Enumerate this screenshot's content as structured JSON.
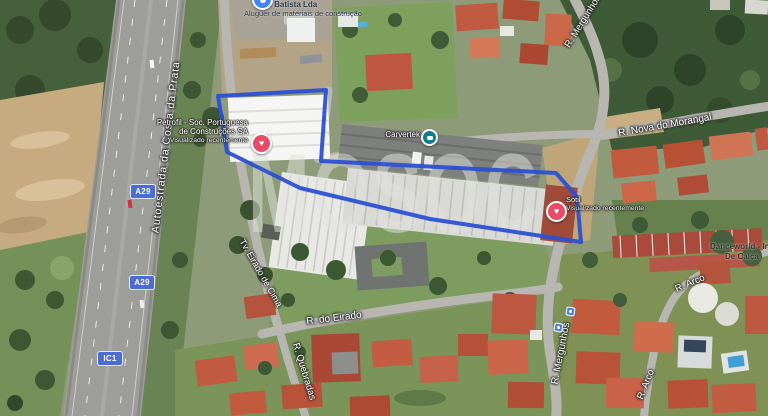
{
  "map": {
    "watermark": "MOSOC",
    "boundary_color": "#2b50d4",
    "icons": {
      "heart": "♥"
    },
    "shields": [
      {
        "label": "A29"
      },
      {
        "label": "A29"
      },
      {
        "label": "IC1"
      }
    ],
    "road_labels": [
      {
        "text": "Autoestrada da Costa da Prata"
      },
      {
        "text": "Tv. Eirado de Cima"
      },
      {
        "text": "R. do Eirado"
      },
      {
        "text": "R. Quebradas"
      },
      {
        "text": "R. Mergunhos"
      },
      {
        "text": "R. Mergunhos"
      },
      {
        "text": "R. Nova do Morangal"
      },
      {
        "text": "R. Arco"
      },
      {
        "text": "R. Arco"
      }
    ],
    "places": {
      "petrofil": {
        "name_line1": "Petrofil - Soc. Portuguesa",
        "name_line2": "de Construções SA",
        "subtitle": "Visualizado recentemente"
      },
      "sotil": {
        "name": "Sotil",
        "subtitle": "Visualizado recentemente"
      },
      "carvertek": {
        "name": "Carvertek"
      },
      "danceworld": {
        "name_line1": "Danceworld - In",
        "name_line2": "De Calça"
      },
      "materials_store": {
        "name_line1": "M. Batista Lda",
        "name_line2": "Aluguer de materiais de construção"
      }
    }
  }
}
